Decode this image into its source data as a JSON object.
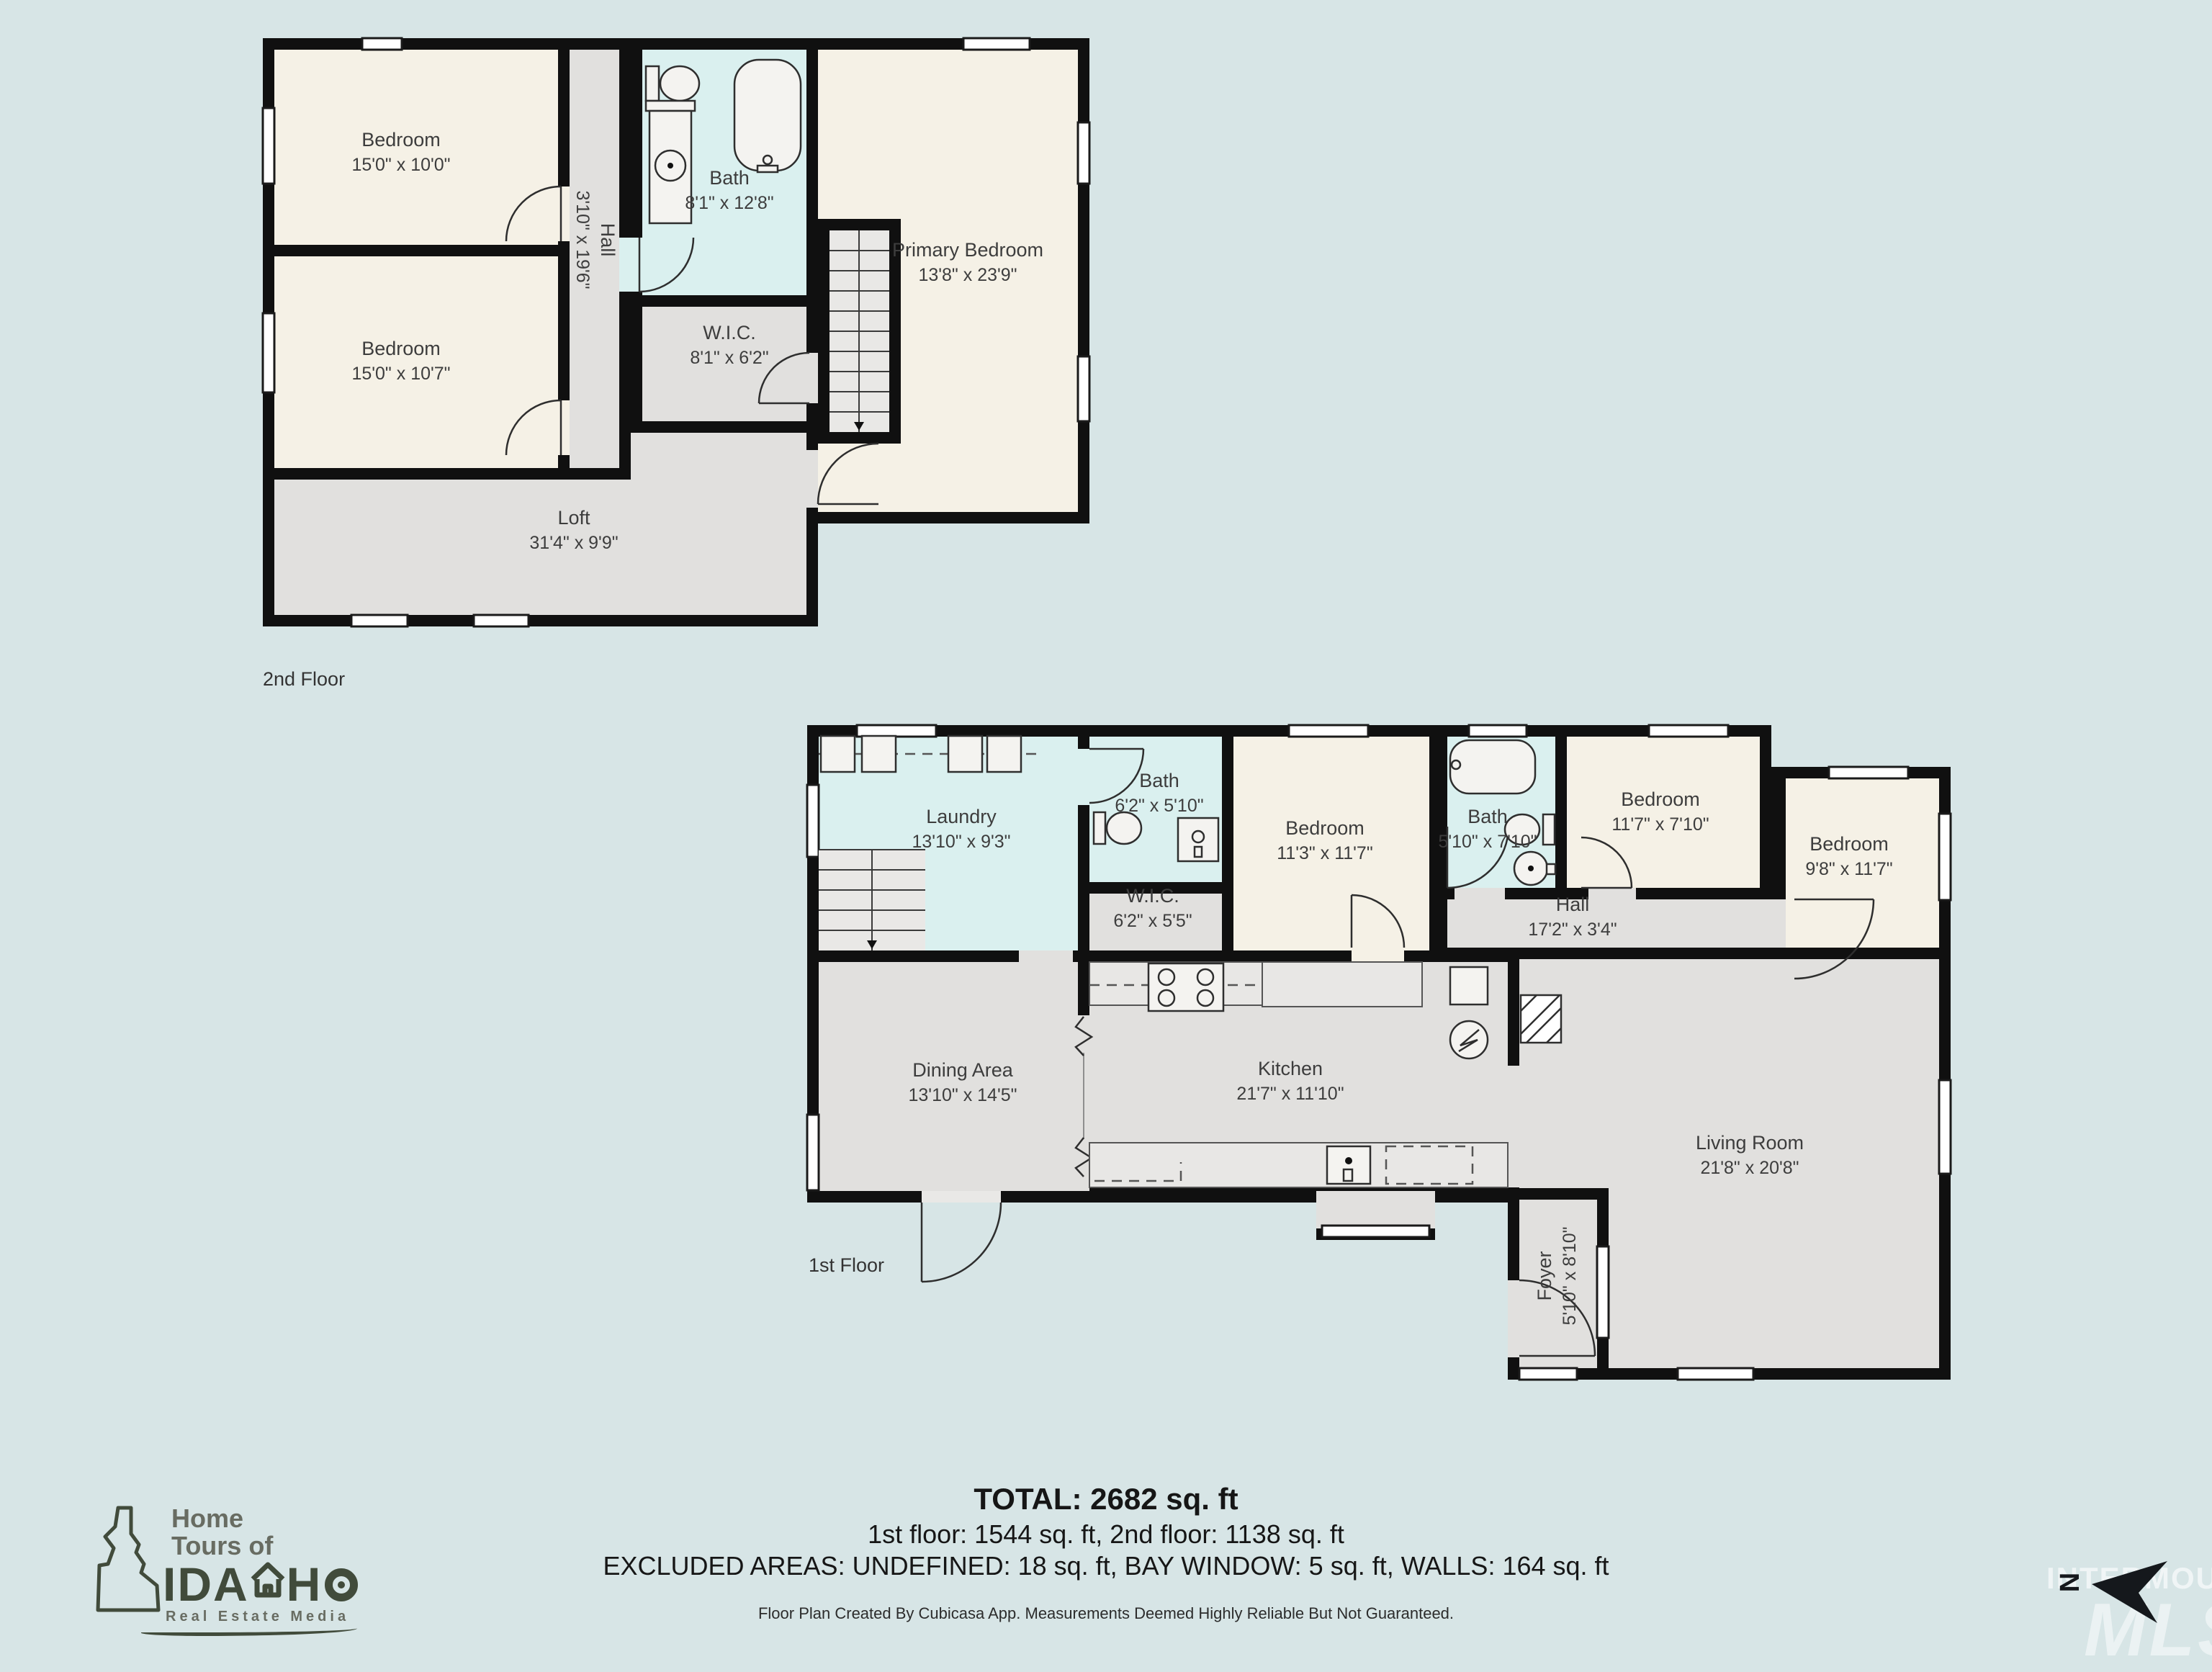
{
  "colors": {
    "bg": "#d7e5e6",
    "wall": "#101010",
    "cream": "#f5f1e6",
    "gray": "#e1e0de",
    "cyan": "#daf0ef",
    "stairs": "#e9e8e6",
    "label": "#3d3d3d",
    "green": "#414b3b",
    "logo-gray": "#686c62",
    "ink": "#161616"
  },
  "floors": [
    {
      "label": "2nd Floor",
      "rooms": [
        {
          "name": "Bedroom",
          "dims": "15'0\" x 10'0\""
        },
        {
          "name": "Bedroom",
          "dims": "15'0\" x 10'7\""
        },
        {
          "name": "Hall",
          "dims": "3'10\" x 19'6\""
        },
        {
          "name": "Bath",
          "dims": "8'1\" x 12'8\""
        },
        {
          "name": "W.I.C.",
          "dims": "8'1\" x 6'2\""
        },
        {
          "name": "Primary Bedroom",
          "dims": "13'8\" x 23'9\""
        },
        {
          "name": "Loft",
          "dims": "31'4\" x 9'9\""
        }
      ]
    },
    {
      "label": "1st Floor",
      "rooms": [
        {
          "name": "Laundry",
          "dims": "13'10\" x 9'3\""
        },
        {
          "name": "Bath",
          "dims": "6'2\" x 5'10\""
        },
        {
          "name": "W.I.C.",
          "dims": "6'2\" x 5'5\""
        },
        {
          "name": "Bedroom",
          "dims": "11'3\" x 11'7\""
        },
        {
          "name": "Bath",
          "dims": "5'10\" x 7'10\""
        },
        {
          "name": "Bedroom",
          "dims": "11'7\" x 7'10\""
        },
        {
          "name": "Bedroom",
          "dims": "9'8\" x 11'7\""
        },
        {
          "name": "Hall",
          "dims": "17'2\" x 3'4\""
        },
        {
          "name": "Dining Area",
          "dims": "13'10\" x 14'5\""
        },
        {
          "name": "Kitchen",
          "dims": "21'7\" x 11'10\""
        },
        {
          "name": "Living Room",
          "dims": "21'8\" x 20'8\""
        },
        {
          "name": "Foyer",
          "dims": "5'10\" x 8'10\""
        }
      ]
    }
  ],
  "summary": {
    "total": "TOTAL: 2682 sq. ft",
    "floors_line": "1st floor: 1544 sq. ft, 2nd floor: 1138 sq. ft",
    "excluded_line": "EXCLUDED AREAS: UNDEFINED: 18 sq. ft, BAY WINDOW: 5 sq. ft, WALLS: 164 sq. ft",
    "disclaimer": "Floor Plan Created By Cubicasa App. Measurements Deemed Highly Reliable But Not Guaranteed."
  },
  "logo": {
    "line1": "Home",
    "line2": "Tours of",
    "name_pre": "IDA",
    "name_post": "H",
    "tagline": "Real Estate Media"
  },
  "compass": {
    "north_label": "N"
  },
  "watermark": {
    "line1": "INTERMOUNTAIN",
    "line2": "MLS"
  }
}
